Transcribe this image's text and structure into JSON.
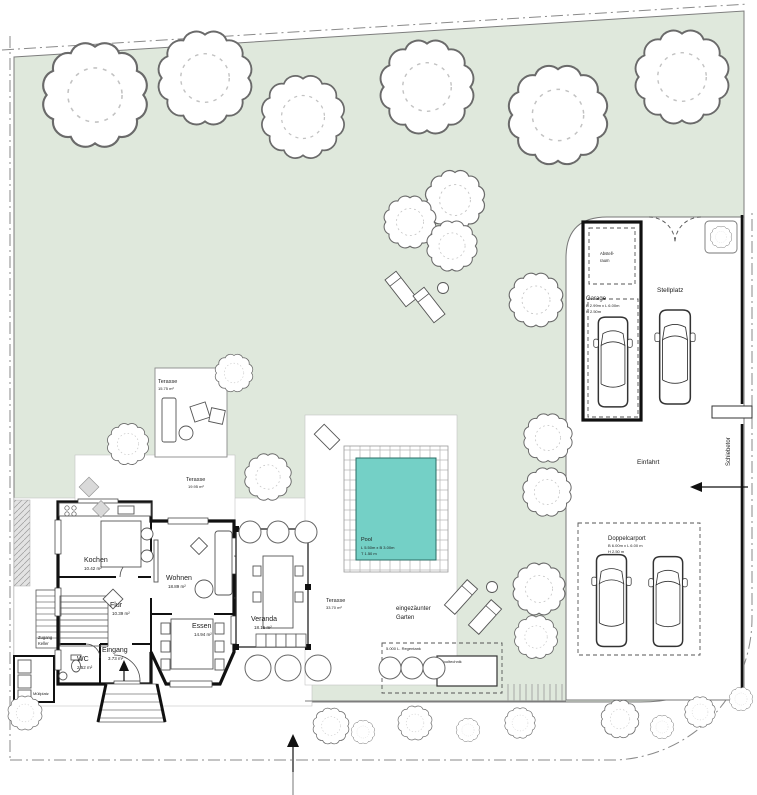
{
  "colors": {
    "garden": "#dfe8dc",
    "pool": "#74d0c6",
    "wall": "#111111"
  },
  "rooms": {
    "kochen": {
      "name": "Kochen",
      "area": "10.42 m²"
    },
    "wohnen": {
      "name": "Wohnen",
      "area": "18.89 m²"
    },
    "flur": {
      "name": "Flur",
      "area": "10.39 m²"
    },
    "essen": {
      "name": "Essen",
      "area": "14.94 m²"
    },
    "wc": {
      "name": "WC",
      "area": "2.52 m²"
    },
    "eingang": {
      "name": "Eingang",
      "area": "3.73 m²"
    },
    "veranda": {
      "name": "Veranda",
      "area": "18.15 m²"
    }
  },
  "terraces": {
    "top": {
      "name": "Terasse",
      "area": "15.75 m²"
    },
    "north": {
      "name": "Terasse",
      "area": "19.95 m²"
    },
    "pool": {
      "name": "Terasse",
      "area": "33.70 m²"
    }
  },
  "pool": {
    "name": "Pool",
    "dims_line1": "L 5.50m x B 3.00m",
    "dims_line2": "T 1.50 m"
  },
  "garden": {
    "label_line1": "eingezäunter",
    "label_line2": "Garten",
    "regentank": "5.000 L. Regentank",
    "pooltechnik": "Pooltechnik",
    "zugang_line1": "Zugang",
    "zugang_line2": "Keller",
    "muellplatz": "Müllplatz"
  },
  "parking": {
    "abstellraum_line1": "Abstell-",
    "abstellraum_line2": "raum",
    "garage": {
      "name": "Garage",
      "dims_line1": "B 2.99m x L 6.00m",
      "dims_line2": "H 2.50m"
    },
    "stellplatz": "Stellplatz",
    "einfahrt": "Einfahrt",
    "schiebetor": "Schiebetor",
    "doppelcarport": {
      "name": "Doppelcarport",
      "dims_line1": "B 6.00m x L 6.00 m",
      "dims_line2": "H 2.50 m"
    }
  }
}
